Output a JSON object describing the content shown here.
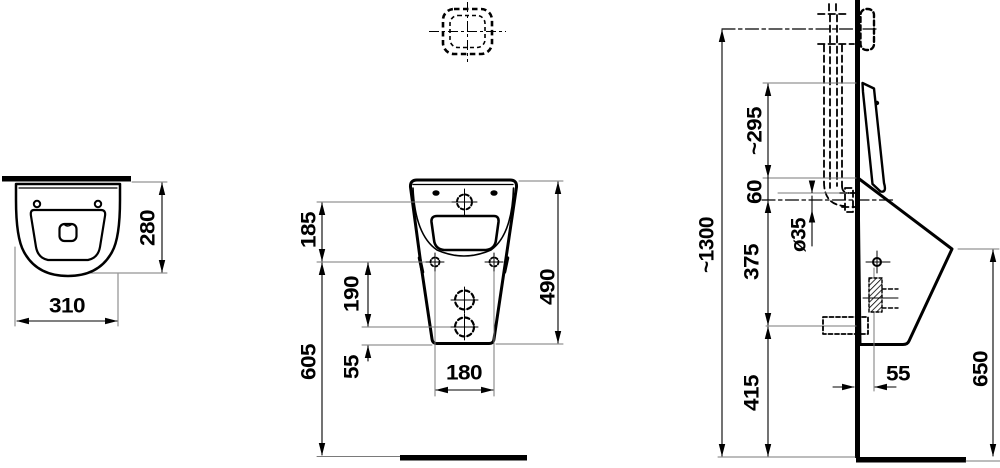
{
  "drawing_type": "technical-dimension-drawing-urinal",
  "colors": {
    "ink": "#000000",
    "extension_line": "#7a7a7a",
    "background": "#ffffff"
  },
  "dimensions": {
    "top_view": {
      "width": "310",
      "depth": "280"
    },
    "front_view": {
      "inlet_to_fixing": "185",
      "fixing_to_outlet": "190",
      "floor_to_fixing": "605",
      "outlet_to_bottom": "55",
      "overall_height": "490",
      "fixing_hole_spacing": "180"
    },
    "side_view": {
      "supply_pipe_height": "~1300",
      "rim_to_mount": "~295",
      "mount_to_inlet": "60",
      "supply_pipe_diameter": "ø35",
      "inlet_to_outlet": "375",
      "outlet_to_floor": "415",
      "front_edge_height": "650",
      "wall_to_outlet": "55"
    }
  }
}
